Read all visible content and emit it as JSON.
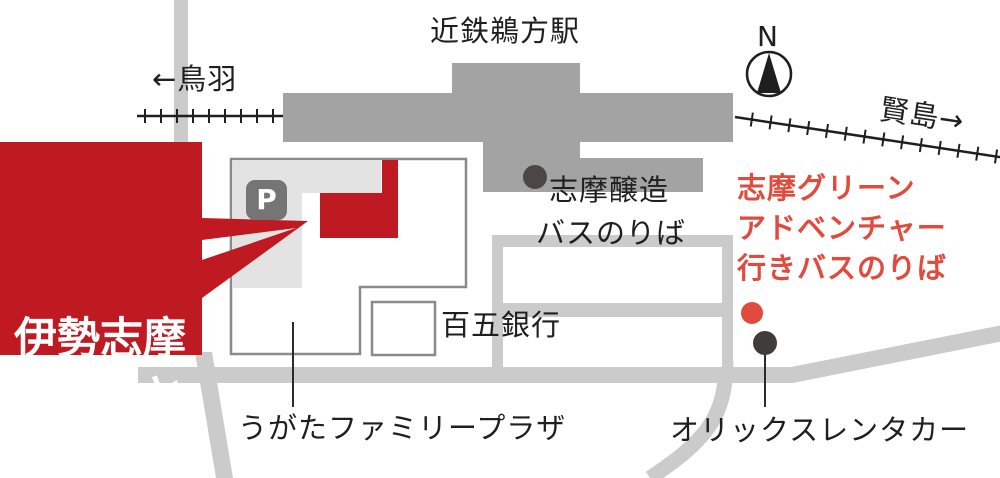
{
  "map": {
    "station_label": "近鉄鵜方駅",
    "direction_west": "←鳥羽",
    "direction_east": "賢島→",
    "compass_north": "N",
    "brewery_label": "志摩醸造",
    "bus_stop_label": "バスのりば",
    "bank_label": "百五銀行",
    "green_bus_label_line1": "志摩グリーン",
    "green_bus_label_line2": "アドベンチャー",
    "green_bus_label_line3": "行きバスのりば",
    "rentacar_label": "オリックスレンタカー",
    "plaza_label": "うがたファミリープラザ",
    "parking_icon_letter": "P"
  },
  "banner": {
    "line1": "伊勢志摩",
    "line2": "ぷらっと",
    "line3": "HOME"
  },
  "colors": {
    "brand_red": "#bf1a22",
    "accent_red": "#e14b3d",
    "station_gray": "#a3a3a3",
    "road_gray": "#cbcbcb",
    "parking_gray": "#e3e3e3",
    "outline_gray": "#8a8a8a",
    "dark_dot": "#403c3a",
    "brewery_dot": "#4c4745",
    "text_black": "#1f1f1f"
  }
}
